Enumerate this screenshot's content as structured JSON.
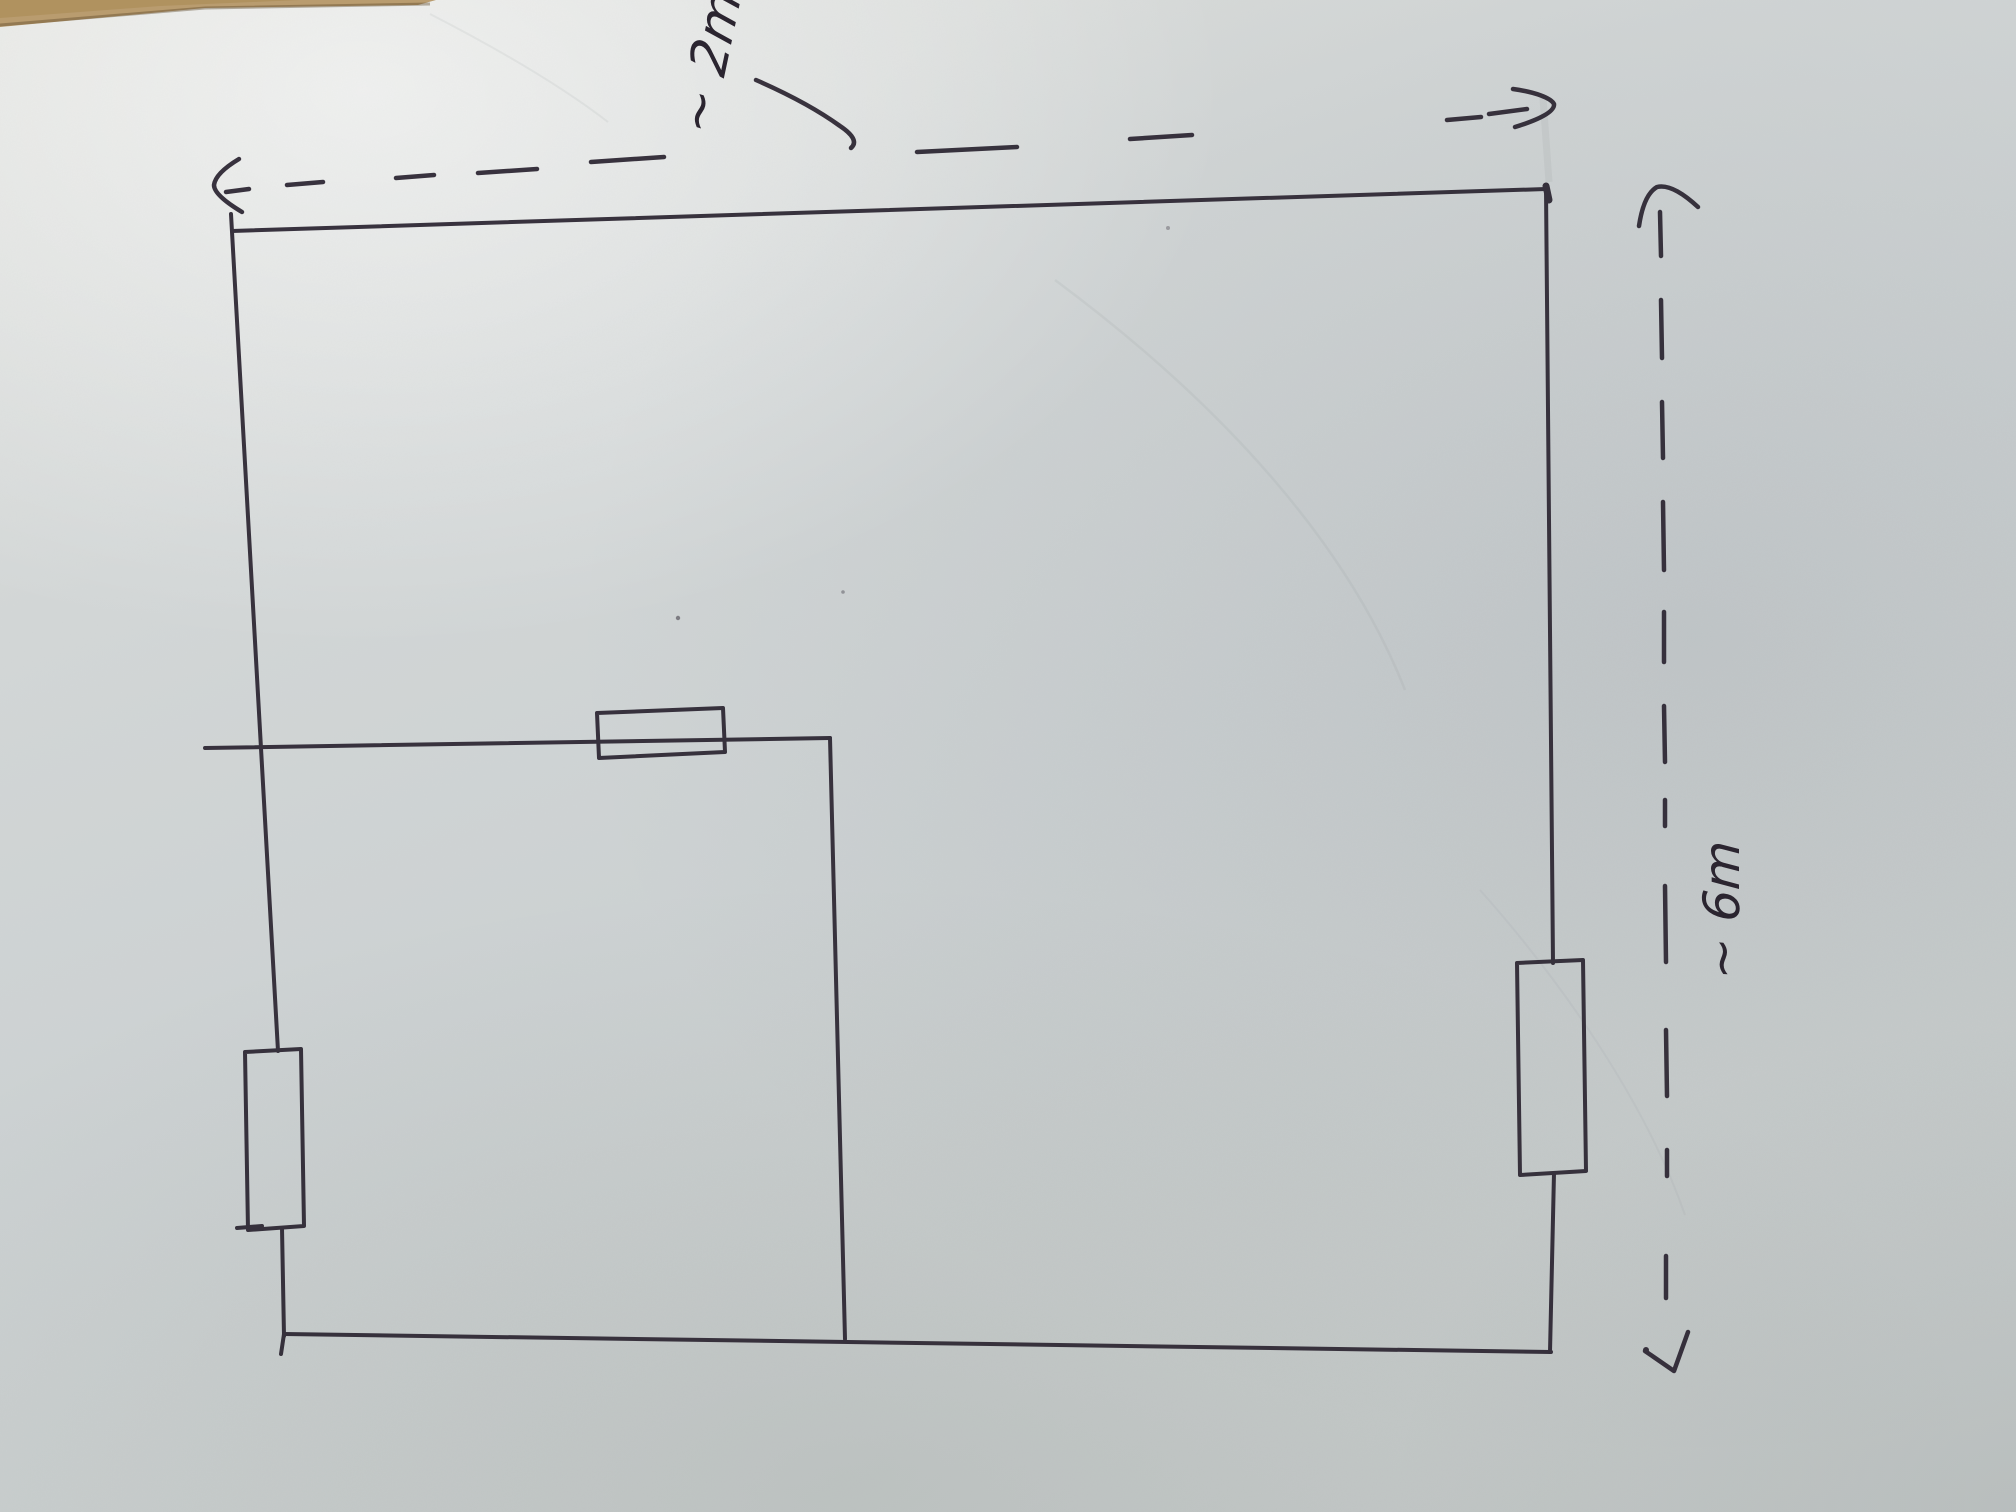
{
  "sketch": {
    "description_labels_only": "hand-drawn room/loop sketch with two dashed dimension arrows",
    "ink_color": "#2f2935",
    "paper_color": "#cdd2d3",
    "table_edge_color": "#b99c6f",
    "dimensions": {
      "top": {
        "label": "~ 2m"
      },
      "right": {
        "label": "~ 6m"
      }
    }
  }
}
